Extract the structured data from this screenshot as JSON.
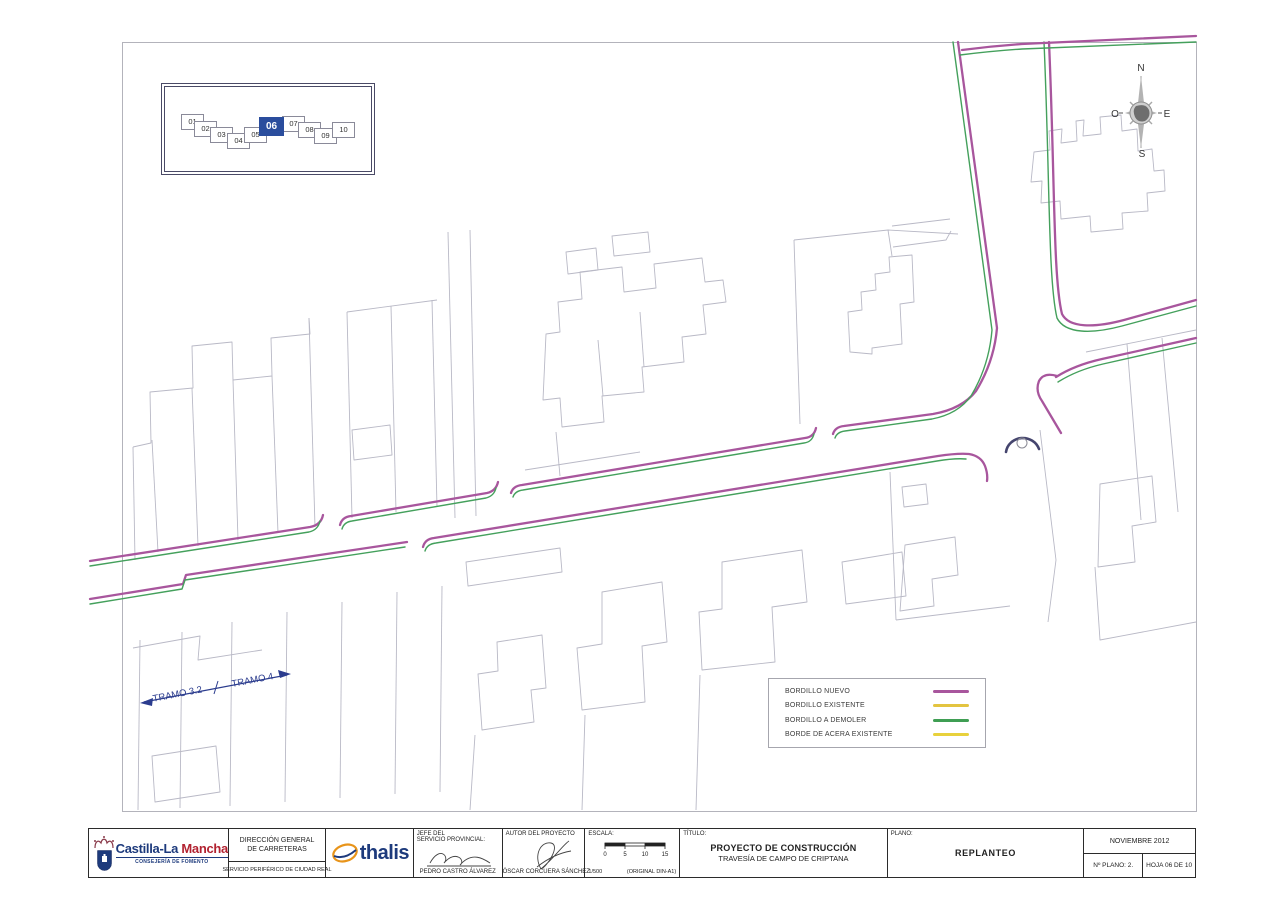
{
  "index_map": {
    "sheets": [
      {
        "label": "01",
        "x": 180,
        "y": 113,
        "active": false
      },
      {
        "label": "02",
        "x": 193,
        "y": 120,
        "active": false
      },
      {
        "label": "03",
        "x": 209,
        "y": 126,
        "active": false
      },
      {
        "label": "04",
        "x": 226,
        "y": 132,
        "active": false
      },
      {
        "label": "05",
        "x": 243,
        "y": 126,
        "active": false
      },
      {
        "label": "06",
        "x": 258,
        "y": 116,
        "active": true
      },
      {
        "label": "07",
        "x": 281,
        "y": 115,
        "active": false
      },
      {
        "label": "08",
        "x": 297,
        "y": 121,
        "active": false
      },
      {
        "label": "09",
        "x": 313,
        "y": 127,
        "active": false
      },
      {
        "label": "10",
        "x": 331,
        "y": 121,
        "active": false
      }
    ],
    "active_color": "#2a4d9d"
  },
  "compass": {
    "north": "N",
    "south": "S",
    "east": "E",
    "west": "O"
  },
  "tramo": {
    "left_label": "TRAMO 3.2",
    "right_label": "TRAMO 4"
  },
  "legend": {
    "items": [
      {
        "label": "BORDILLO NUEVO",
        "color": "#a8569d"
      },
      {
        "label": "BORDILLO EXISTENTE",
        "color": "#e3c440"
      },
      {
        "label": "BORDILLO A DEMOLER",
        "color": "#3f9e53"
      },
      {
        "label": "BORDE DE ACERA EXISTENTE",
        "color": "#e8d13c"
      }
    ]
  },
  "titleblock": {
    "agency": {
      "name_1": "Castilla-La ",
      "name_2": "Mancha",
      "subtitle": "CONSEJERÍA DE FOMENTO"
    },
    "direccion": {
      "line1": "DIRECCIÓN GENERAL",
      "line2": "DE CARRETERAS",
      "line3": "SERVICIO PERIFÉRICO DE CIUDAD REAL"
    },
    "consultant": {
      "name": "thalis"
    },
    "jefe": {
      "label1": "JEFE DEL",
      "label2": "SERVICIO PROVINCIAL:",
      "name": "PEDRO CASTRO ÁLVAREZ"
    },
    "autor": {
      "label": "AUTOR DEL PROYECTO",
      "name": "ÓSCAR CORCUERA SÁNCHEZ"
    },
    "escala": {
      "label": "ESCALA:",
      "ratio": "1/500",
      "original": "(ORIGINAL DIN-A1)",
      "ticks": [
        "0",
        "5",
        "10",
        "15"
      ]
    },
    "titulo": {
      "label": "TÍTULO:",
      "line1": "PROYECTO DE CONSTRUCCIÓN",
      "line2": "TRAVESÍA DE CAMPO DE CRIPTANA"
    },
    "plano": {
      "label": "PLANO:",
      "value": "REPLANTEO"
    },
    "fecha": {
      "date": "NOVIEMBRE 2012",
      "num_label": "Nº PLANO:",
      "num_value": "2.",
      "hoja": "HOJA 06 DE 10"
    }
  },
  "map": {
    "colors": {
      "m": "#a8569d",
      "g": "#44a05c",
      "i": "#45456e"
    },
    "widths": {
      "m": 2.3,
      "g": 1.4,
      "i": 2.6
    },
    "island_bollard": {
      "cx": 1022,
      "cy": 443,
      "r": 5
    },
    "curbs": [
      {
        "d": "M 90,561 L 310,527 Q 321,525 323,515",
        "c": "m"
      },
      {
        "d": "M 90,566 L 309,532 Q 318,530 320,521",
        "c": "g"
      },
      {
        "d": "M 340,525 Q 342,517 351,516 L 487,493 Q 496,491 498,482",
        "c": "m"
      },
      {
        "d": "M 342,529 Q 344,522 352,521 L 486,498 Q 494,496 496,488",
        "c": "g"
      },
      {
        "d": "M 511,493 Q 513,486 522,485 L 805,438 Q 814,437 816,428",
        "c": "m"
      },
      {
        "d": "M 513,497 Q 515,491 523,490 L 804,443 Q 812,442 814,434",
        "c": "g"
      },
      {
        "d": "M 833,434 Q 835,427 844,426 L 933,414 Q 962,409 976,391 Q 994,362 997,328 L 958,42",
        "c": "m"
      },
      {
        "d": "M 835,438 Q 837,432 845,431 L 932,419 Q 958,414 971,396 Q 989,366 992,330 L 953,42",
        "c": "g"
      },
      {
        "d": "M 90,599 L 183,584 L 186,575 L 407,542",
        "c": "m"
      },
      {
        "d": "M 90,604 L 182,589 L 185,580 L 405,547",
        "c": "g"
      },
      {
        "d": "M 423,547 Q 425,539 434,538 L 938,456 Q 958,453 969,454 Q 981,456 985,466 Q 988,474 987,481",
        "c": "m"
      },
      {
        "d": "M 425,551 Q 427,544 436,543 L 937,461 Q 955,458 966,459",
        "c": "g"
      },
      {
        "d": "M 1044,42 C 1050,180 1048,280 1057,318 C 1065,334 1092,334 1122,326 L 1196,306",
        "c": "g"
      },
      {
        "d": "M 1049,42 C 1055,180 1053,278 1062,314 C 1069,328 1094,328 1124,320 L 1196,300",
        "c": "m"
      },
      {
        "d": "M 1056,377 Q 1075,365 1102,359 L 1196,338",
        "c": "m"
      },
      {
        "d": "M 1058,382 Q 1077,370 1103,364 L 1196,343",
        "c": "g"
      },
      {
        "d": "M 1057,376 Q 1044,372 1039,381 Q 1035,391 1042,401 L 1061,433",
        "c": "m"
      },
      {
        "d": "M 962,50 Q 992,46 1022,44 L 1196,36",
        "c": "m"
      },
      {
        "d": "M 960,55 Q 992,51 1022,49 L 1196,42",
        "c": "g"
      },
      {
        "d": "M 1006,452 A 17,16 0 0 1 1039,449",
        "c": "i"
      }
    ],
    "outlines": [
      "M 133,447 L 151,443 L 150,392 L 193,388 L 192,346 L 232,342 L 233,380 L 272,376 L 271,338 L 310,334 L 309,318",
      "M 133,447 L 135,560",
      "M 152,440 L 158,552",
      "M 192,388 L 198,546",
      "M 233,380 L 238,540",
      "M 272,376 L 278,533",
      "M 309,318 L 315,527",
      "M 347,312 L 352,518",
      "M 391,306 L 396,512",
      "M 432,300 L 437,507",
      "M 347,312 L 437,300",
      "M 352,430 L 390,425 L 392,455 L 354,460 Z",
      "M 448,232 L 455,518",
      "M 470,230 L 476,516",
      "M 546,334 L 560,332 L 558,302 L 582,299 L 580,272 L 622,267 L 624,292 L 656,288 L 654,264 L 702,258 L 705,282 L 723,280 L 726,302 L 703,305 L 706,334 L 682,337 L 684,362 L 642,367 L 644,392 L 602,396 L 604,422 L 562,427 L 560,398 L 543,400 Z",
      "M 566,252 L 596,248 L 598,270 L 568,274 Z",
      "M 612,236 L 648,232 L 650,252 L 614,256 Z",
      "M 603,396 L 598,340",
      "M 644,367 L 640,312",
      "M 794,240 L 888,230 L 958,234",
      "M 794,240 L 800,424",
      "M 888,230 L 892,256",
      "M 850,352 L 848,312 L 862,310 L 861,292 L 876,290 L 875,274 L 890,272 L 889,257 L 912,255 L 914,302 L 900,304 L 902,344 L 872,348 L 872,354 Z",
      "M 892,226 L 950,219",
      "M 893,247 L 946,240 L 951,231",
      "M 1034,152 L 1050,150 L 1049,131 L 1062,129 L 1061,143 L 1077,141 L 1076,121 L 1084,120 L 1083,136 L 1101,134 L 1100,117 L 1121,115 L 1122,131 L 1137,129 L 1138,151 L 1152,149 L 1154,171 L 1164,170 L 1165,191 L 1147,193 L 1148,211 L 1122,213 L 1123,229 L 1091,232 L 1090,216 L 1061,219 L 1060,201 L 1041,203 L 1042,181 L 1031,182 Z",
      "M 1086,352 L 1196,330",
      "M 1127,344 L 1141,520",
      "M 1162,338 L 1178,512",
      "M 1100,484 L 1152,476 L 1156,522 L 1132,526 L 1135,562 L 1098,567 Z",
      "M 1095,567 L 1100,640 L 1196,622",
      "M 902,487 L 926,484 L 928,504 L 904,507 Z",
      "M 890,472 L 896,620",
      "M 896,620 L 1010,606",
      "M 1040,430 L 1056,560 L 1048,622",
      "M 905,545 L 955,537 L 958,575 L 932,579 L 934,606 L 900,611 Z",
      "M 466,562 L 560,548 L 562,572 L 468,586 Z",
      "M 497,642 L 542,635 L 546,688 L 531,690 L 534,722 L 482,730 L 478,674 L 498,671 Z",
      "M 602,592 L 662,582 L 667,642 L 642,646 L 645,702 L 582,710 L 577,648 L 602,644 Z",
      "M 722,562 L 802,550 L 807,602 L 772,607 L 775,662 L 702,670 L 699,612 L 722,609 Z",
      "M 842,562 L 902,552 L 906,596 L 846,604 Z",
      "M 140,640 L 138,810",
      "M 182,632 L 180,808",
      "M 232,622 L 230,806",
      "M 287,612 L 285,802",
      "M 342,602 L 340,798",
      "M 397,592 L 395,794",
      "M 442,586 L 440,792",
      "M 133,648 L 200,636 L 198,660 L 262,650",
      "M 152,756 L 216,746 L 220,792 L 155,802 Z",
      "M 475,735 L 470,810",
      "M 585,715 L 582,810",
      "M 700,675 L 696,810",
      "M 525,470 L 640,452",
      "M 560,476 L 556,432"
    ]
  }
}
